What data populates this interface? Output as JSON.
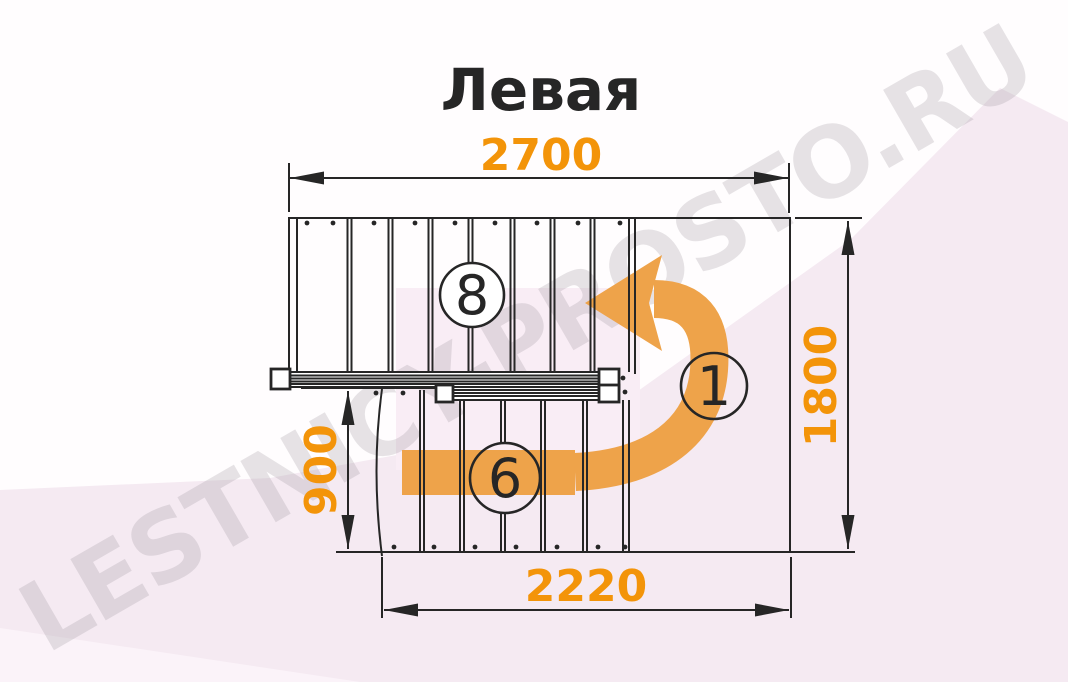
{
  "title": "Левая",
  "watermark": "LESTNICY-PROSTO.RU",
  "diagram": {
    "type": "stair-plan-top-view",
    "turn_direction_label": "Левая",
    "dimensions": {
      "total_width_mm": "2700",
      "total_depth_mm": "1800",
      "lower_flight_depth_mm": "900",
      "bottom_width_mm": "2220"
    },
    "step_badges": {
      "upper_flight_steps": "8",
      "landing_count": "1",
      "lower_flight_steps": "6"
    }
  },
  "colors": {
    "accent_orange": "#F39409",
    "arrow_orange": "#EEA34A",
    "line_dark": "#262626",
    "bg_pink": "#F5EAF2",
    "bg_pink_light": "#F9EDF5",
    "bg_pink_lighter": "#FBF3F9",
    "watermark_gray": "#8F8890",
    "paper_white": "#FFFFFF"
  }
}
